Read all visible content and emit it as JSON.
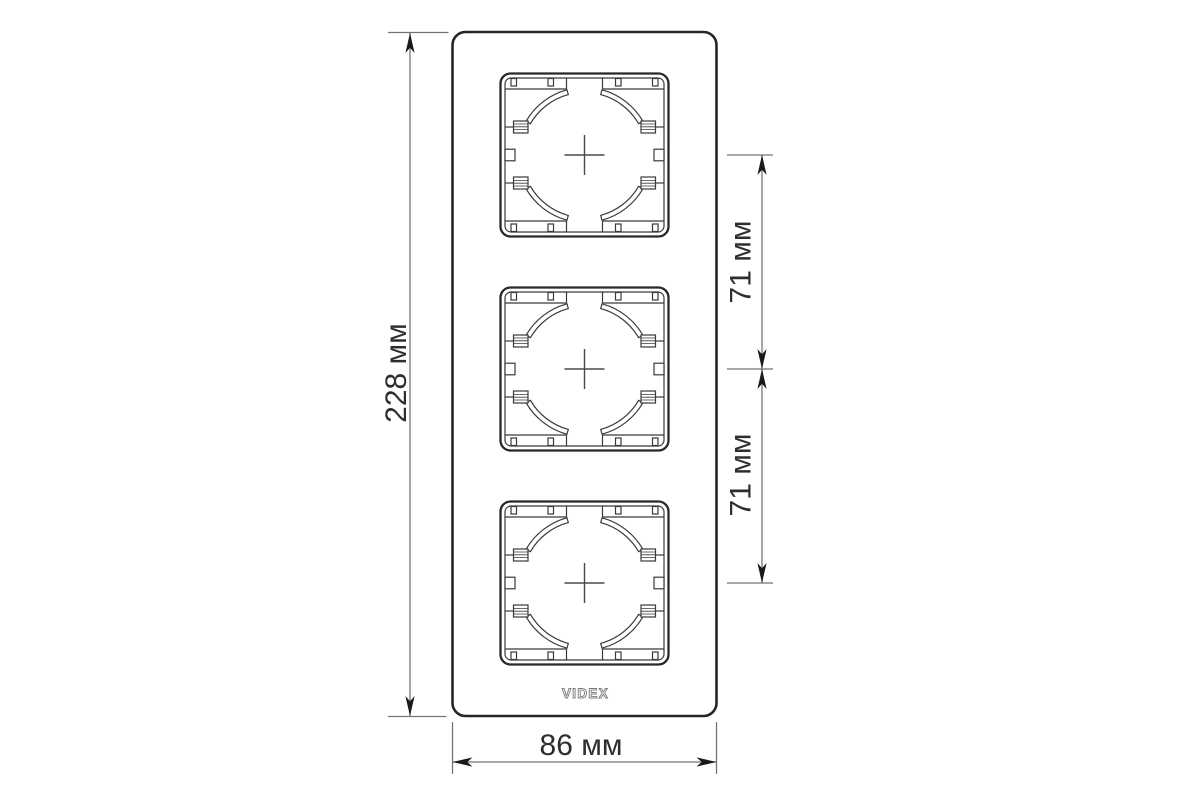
{
  "labels": {
    "height": "228 мм",
    "width": "86 мм",
    "spacing_top": "71 мм",
    "spacing_bottom": "71 мм"
  },
  "logo": {
    "brand": "VIDEX"
  },
  "figure": {
    "socket_openings_count": 3
  },
  "colors": {
    "background": "#ffffff",
    "frame_outline": "#262626",
    "detail_line": "#3a3a3a",
    "dimension_line": "#757575",
    "arrow": "#1a1a1a",
    "label_text": "#2e2e2e",
    "logo_outline": "#7e7e7e"
  }
}
